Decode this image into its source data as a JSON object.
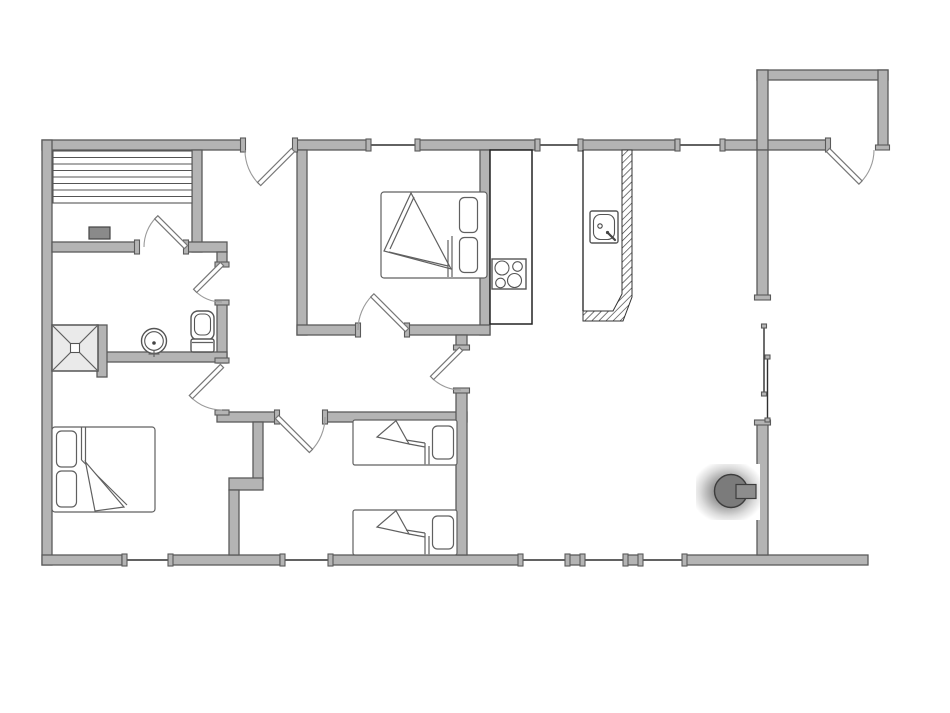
{
  "page": {
    "title": "Holiday home floor plan",
    "background": "#ffffff"
  },
  "colors": {
    "wall-fill": "#b4b4b4",
    "wall-outline": "#5a5a5a",
    "fixture-outline": "#555555",
    "thin-line": "#2f2f2f",
    "door-arc": "#9a9a9a",
    "bed-line": "#606060",
    "heater-fill": "#8a8a8a",
    "stove-body": "#7b7b7b",
    "shower-fill": "#eaeaea",
    "bg": "#ffffff"
  },
  "fixtures": {
    "sauna": [
      "sauna-bench",
      "sauna-heater"
    ],
    "bathroom": [
      "shower",
      "washbasin",
      "toilet"
    ],
    "kitchen": [
      "kitchen-counter",
      "cooktop-4-burners",
      "island-counter",
      "kitchen-sink"
    ],
    "living_room": [
      "wood-stove",
      "sliding-terrace-door"
    ],
    "bedrooms": [
      "double-bed",
      "double-bed",
      "single-bed",
      "single-bed"
    ],
    "entrance": [
      "porch"
    ]
  },
  "openings": {
    "hinged_doors": 8,
    "sliding_doors": 1,
    "windows_top_wall": 3,
    "windows_bottom_wall": 5
  }
}
